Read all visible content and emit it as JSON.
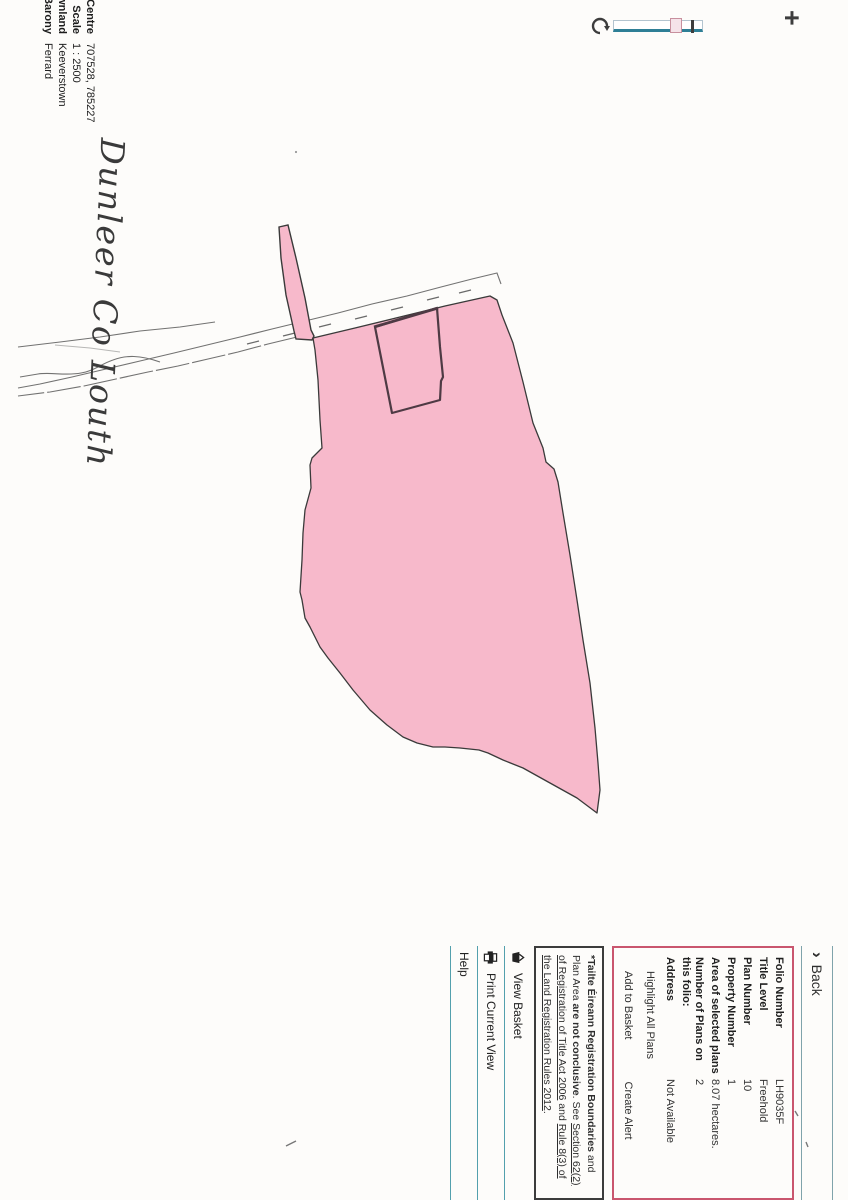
{
  "map_info": {
    "rows": [
      {
        "label": "Centre",
        "value": "707528, 785227"
      },
      {
        "label": "Scale",
        "value": "1 : 2500"
      },
      {
        "label": "Townland",
        "value": "Keeverstown"
      },
      {
        "label": "Barony",
        "value": "Ferrard"
      }
    ]
  },
  "annotation": {
    "handwritten": "Dunleer Co Louth"
  },
  "zoom_control": {
    "zoom_in": "+",
    "reset_icon": "refresh-icon"
  },
  "panel": {
    "back_chevron": "›",
    "back_label": "Back",
    "folio": {
      "rows": [
        [
          "Folio Number",
          "LH9035F"
        ],
        [
          "Title Level",
          "Freehold"
        ],
        [
          "Plan Number",
          "10"
        ],
        [
          "Property Number",
          "1"
        ],
        [
          "Area of selected plans",
          "8.07 hectares."
        ],
        [
          "Number of Plans on this folio:",
          "2"
        ],
        [
          "Address",
          "Not Available"
        ]
      ],
      "highlight_link": "Highlight All Plans",
      "add_to_basket": "Add to Basket",
      "create_alert": "Create Alert"
    },
    "disclaimer": {
      "lead_bold": "*Tailte Éireann Registration Boundaries",
      "seg1": " and Plan Area ",
      "bold2": "are not conclusive",
      "seg2": ". See ",
      "link1": "Section 62(2) of Registration of Title Act 2006",
      "seg3": " and ",
      "link2": "Rule 8(3) of the Land Registration Rules 2012",
      "seg4": "."
    },
    "menu": [
      {
        "icon": "basket-icon",
        "label": "View Basket"
      },
      {
        "icon": "printer-icon",
        "label": "Print Current View"
      },
      {
        "icon": "",
        "label": "Help"
      }
    ]
  },
  "map": {
    "parcel_name": "selected-folio-plan",
    "colors": {
      "parcel_fill": "#f7b9cb",
      "parcel_outline": "#3a3a3a",
      "plot_outline": "#4e3a44",
      "folio_box_border": "#c9566e",
      "disclaimer_border": "#3c3c3c",
      "separator_teal": "#53a0ad",
      "slider_accent": "#2e7f96",
      "road_line": "#5a5a5a"
    }
  }
}
